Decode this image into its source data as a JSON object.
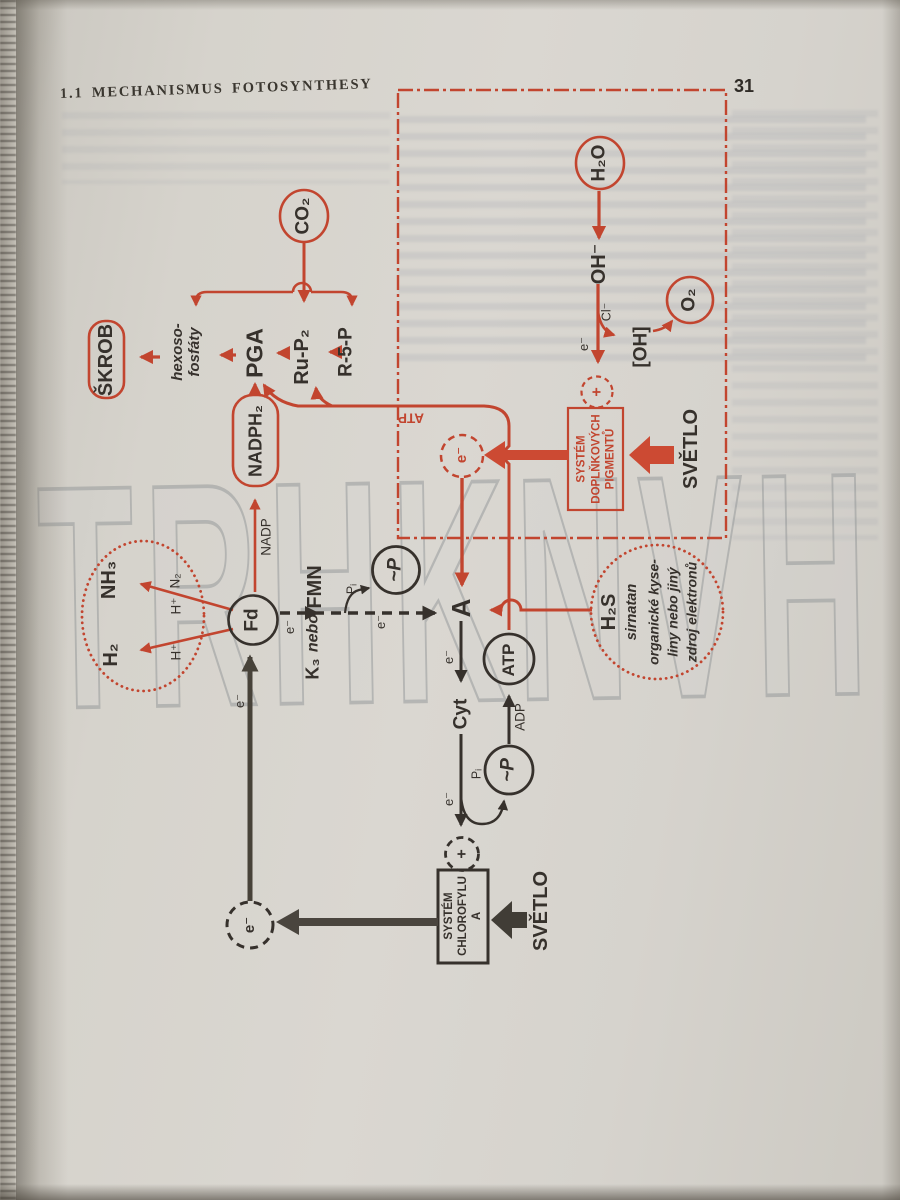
{
  "header": {
    "title": "1.1 MECHANISMUS FOTOSYNTHESY",
    "page_number": "31"
  },
  "watermark": {
    "text": "TRHKNVH"
  },
  "colors": {
    "red": "#c2452f",
    "ink": "#36312c",
    "paper": "#d6d3cc"
  },
  "diagram": {
    "h2o": "H₂O",
    "oh_minus": "OH⁻",
    "cl_minus": "Cl⁻",
    "oh_radical": "[OH]",
    "o2": "O₂",
    "plus": "+",
    "e_minus": "e⁻",
    "pigments_box": "SYSTÉM\nDOPLŇKOVÝCH\nPIGMENTŮ",
    "svetlo": "SVĚTLO",
    "co2": "CO₂",
    "skrob": "ŠKROB",
    "hexoso": "hexoso-\nfosfáty",
    "pga": "PGA",
    "ru_p2": "Ru-P₂",
    "r5p": "R-5-P",
    "nadph2": "NADPH₂",
    "nadp": "NADP",
    "atp_small": "ATP",
    "fd": "Fd",
    "k3": "K₃",
    "nebo": "nebo",
    "fmn": "FMN",
    "nh3": "NH₃",
    "h2": "H₂",
    "n2": "N₂",
    "h_plus": "H⁺",
    "tilde_p": "~P",
    "pi": "Pᵢ",
    "a": "A",
    "cyt": "Cyt",
    "adp": "ADP",
    "atp": "ATP",
    "chlorophyll_box": "SYSTÉM\nCHLOROFYLU\nA",
    "h2s": "H₂S",
    "sirnatan": "sirnatan",
    "h2s_note": "organické kyse-\nliny nebo jiný\nzdroj elektronů"
  }
}
